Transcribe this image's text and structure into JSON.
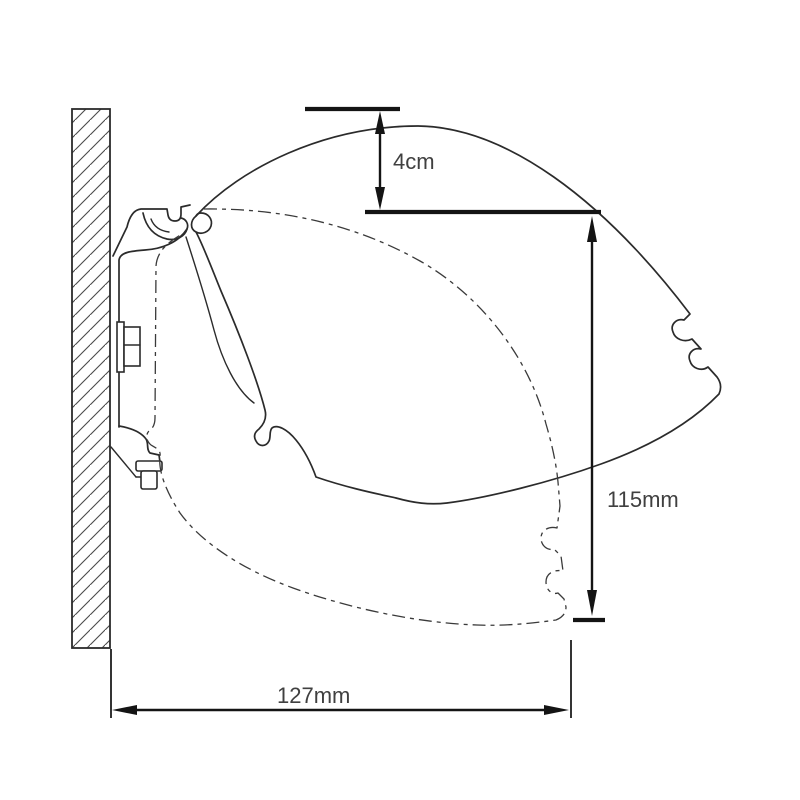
{
  "drawing": {
    "type": "technical-cross-section",
    "line_color": "#2b2b2b",
    "dashdot_color": "#3a3a3a",
    "dimension_color": "#141414",
    "text_color": "#404040",
    "background": "#ffffff",
    "linework": {
      "solid_outline": "cassette shown in open position",
      "dashdot_outline": "cassette shown rotated to closed position"
    }
  },
  "dimensions": {
    "gap": {
      "label": "4cm"
    },
    "height": {
      "label": "115mm"
    },
    "projection": {
      "label": "127mm"
    }
  }
}
